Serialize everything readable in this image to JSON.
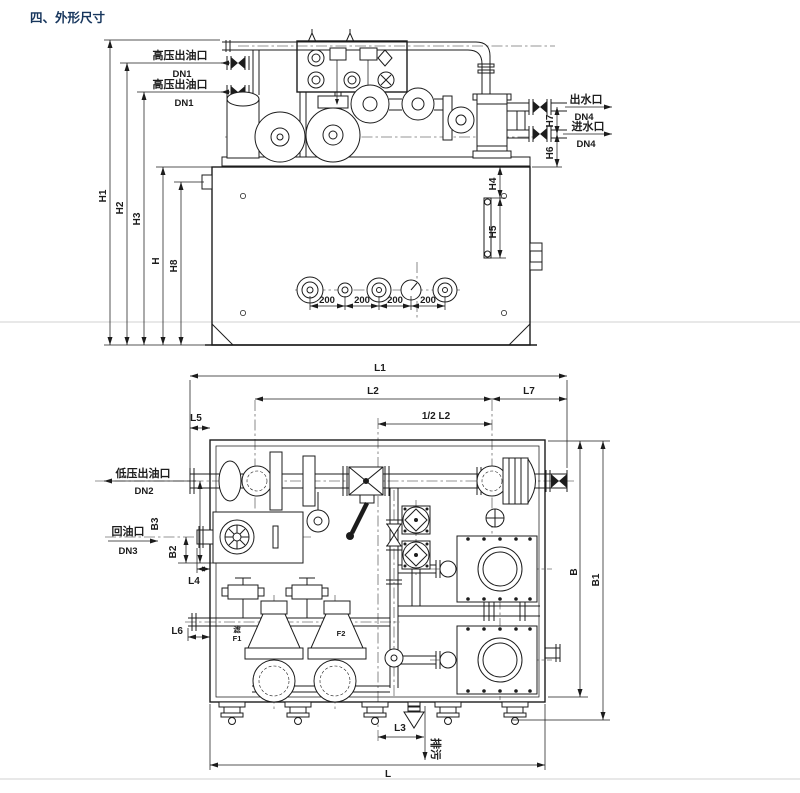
{
  "title": "四、外形尺寸",
  "colors": {
    "title": "#17365D",
    "line": "#1c1c1c"
  },
  "front_view": {
    "ports": {
      "hp_outlet_1": {
        "name": "高压出油口",
        "dn": "DN1"
      },
      "hp_outlet_2": {
        "name": "高压出油口",
        "dn": "DN1"
      },
      "water_outlet": {
        "name": "出水口",
        "dn": "DN4"
      },
      "water_inlet": {
        "name": "进水口",
        "dn": "DN4"
      }
    },
    "dims": {
      "h1": "H1",
      "h2": "H2",
      "h3": "H3",
      "h": "H",
      "h8": "H8",
      "h4": "H4",
      "h5": "H5",
      "h6": "H6",
      "h7": "H7"
    },
    "gauge_spacing": [
      "200",
      "200",
      "200",
      "200"
    ]
  },
  "plan_view": {
    "ports": {
      "lp_outlet": {
        "name": "低压出油口",
        "dn": "DN2"
      },
      "oil_return": {
        "name": "回油口",
        "dn": "DN3"
      },
      "drain": {
        "name": "排污"
      }
    },
    "dims": {
      "l1": "L1",
      "l2": "L2",
      "half_l2": "1/2 L2",
      "l7": "L7",
      "l5": "L5",
      "l4": "L4",
      "l6": "L6",
      "l3": "L3",
      "l": "L",
      "b": "B",
      "b1": "B1",
      "b2": "B2",
      "b3": "B3"
    },
    "labels": {
      "f1_prefix": "滤",
      "f1": "F1",
      "f2": "F2"
    }
  }
}
